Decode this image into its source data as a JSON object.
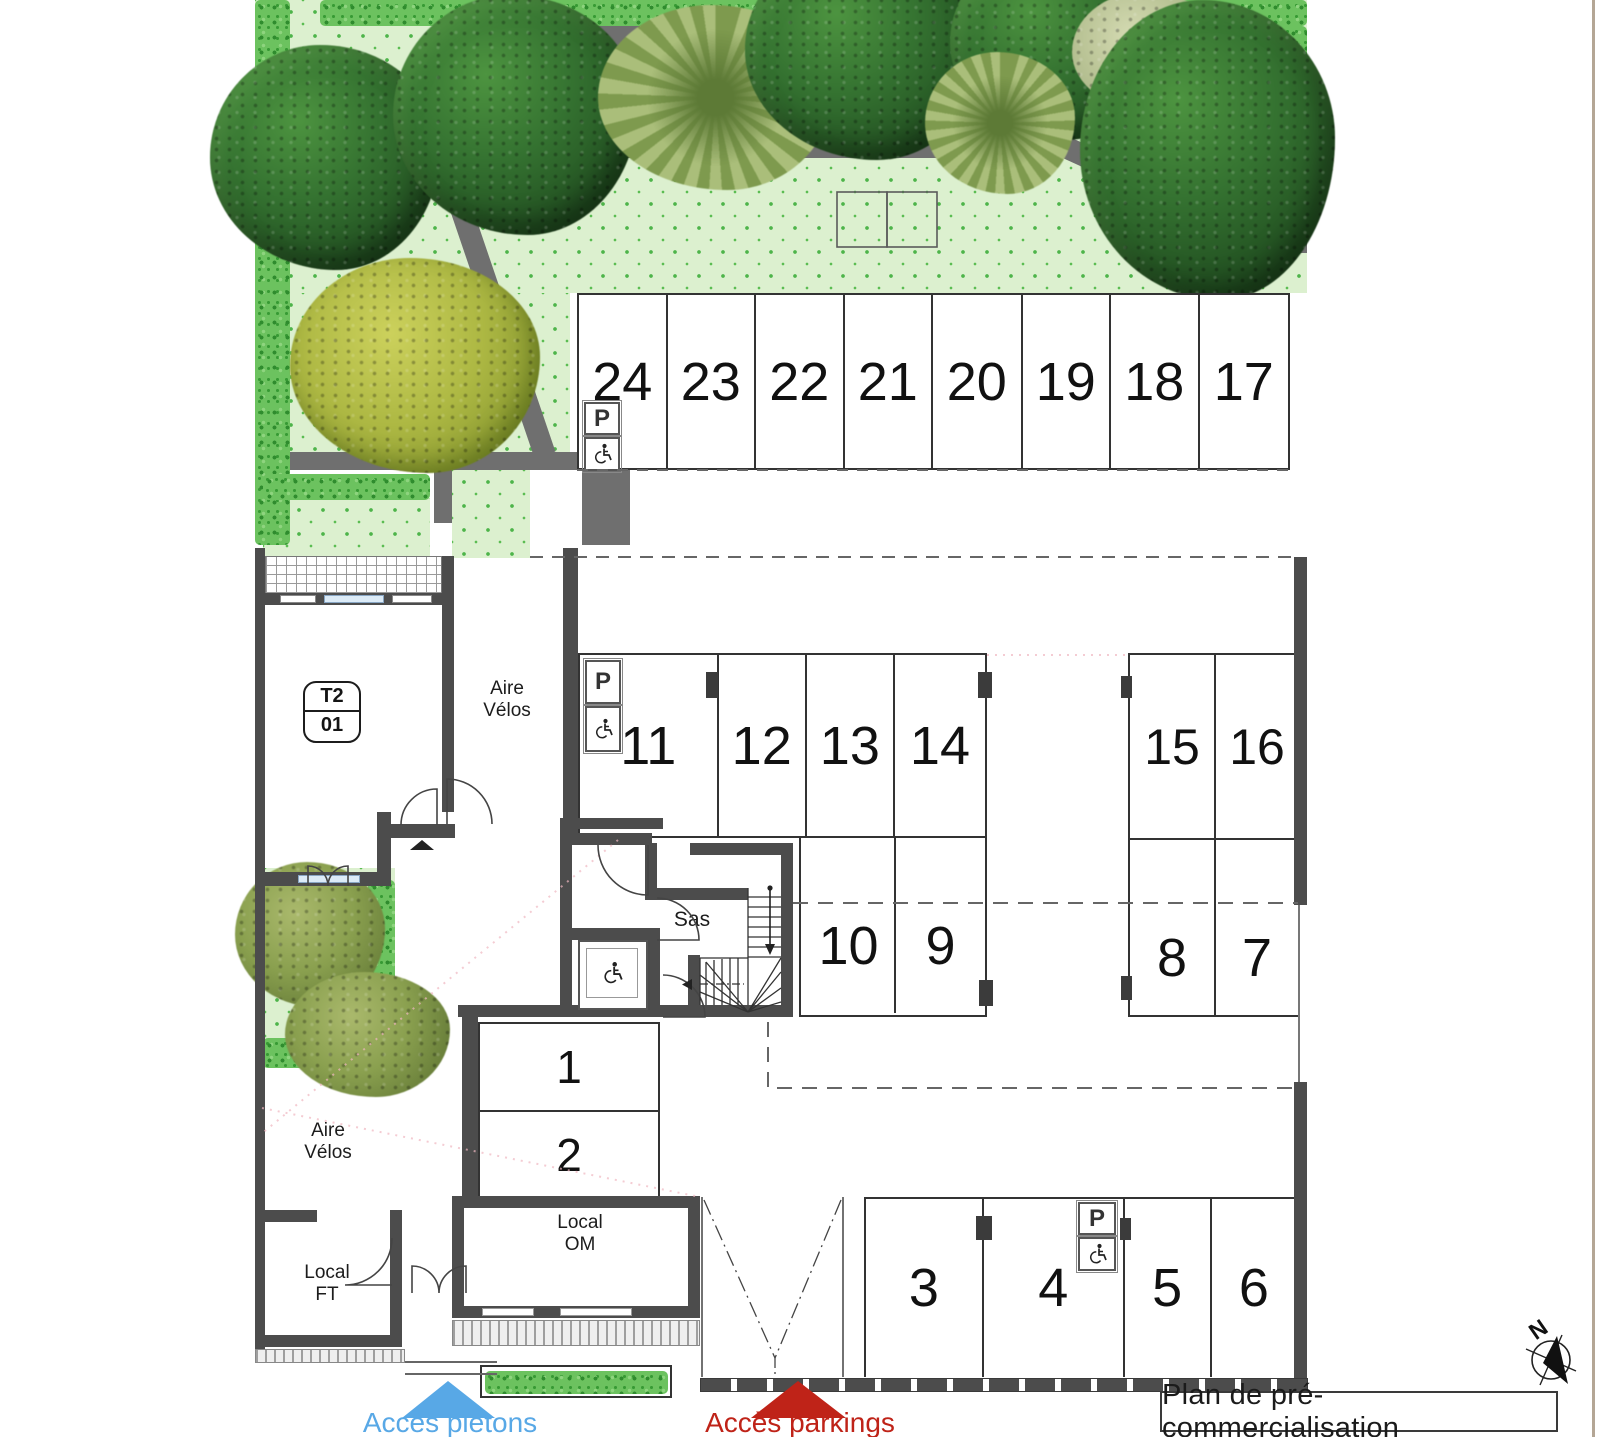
{
  "title": {
    "label": "Plan de pré-commercialisation"
  },
  "compass": {
    "label": "N"
  },
  "access": {
    "pedestrian": {
      "label": "Accès piétons",
      "color": "#58a8e6"
    },
    "parking": {
      "label": "Accès parkings",
      "color": "#bf2318"
    }
  },
  "rooms": {
    "t2_unit": {
      "type": "T2",
      "number": "01"
    },
    "aire_velos_upper": {
      "line1": "Aire",
      "line2": "Vélos"
    },
    "aire_velos_lower": {
      "line1": "Aire",
      "line2": "Vélos"
    },
    "local_om": {
      "line1": "Local",
      "line2": "OM"
    },
    "local_ft": {
      "line1": "Local",
      "line2": "FT"
    },
    "sas": {
      "label": "Sas"
    }
  },
  "parking": {
    "handicap_sign_letter": "P",
    "row_top": {
      "stalls": [
        "24",
        "23",
        "22",
        "21",
        "20",
        "19",
        "18",
        "17"
      ]
    },
    "row_mid_left": {
      "stalls": [
        "11",
        "12",
        "13",
        "14"
      ]
    },
    "row_mid_right": {
      "stalls": [
        "15",
        "16"
      ]
    },
    "row_lower_left": {
      "stalls": [
        "10",
        "9"
      ]
    },
    "row_lower_right": {
      "stalls": [
        "8",
        "7"
      ]
    },
    "indoor_pair": {
      "stalls": [
        "1",
        "2"
      ]
    },
    "row_bottom": {
      "stalls": [
        "3",
        "4",
        "5",
        "6"
      ]
    }
  },
  "colors": {
    "lawn": "#dcf0cf",
    "lawn_symbol": "#4eb44a",
    "hedge": "#6cc25f",
    "path": "#6f6f6f",
    "wall": "#4c4c4c",
    "line": "#333333",
    "access_pedestrian": "#58a8e6",
    "access_parking": "#bf2318",
    "tree_dark": "#2e6b28",
    "tree_palm": "#8fa457",
    "tree_yellow": "#adb843"
  }
}
